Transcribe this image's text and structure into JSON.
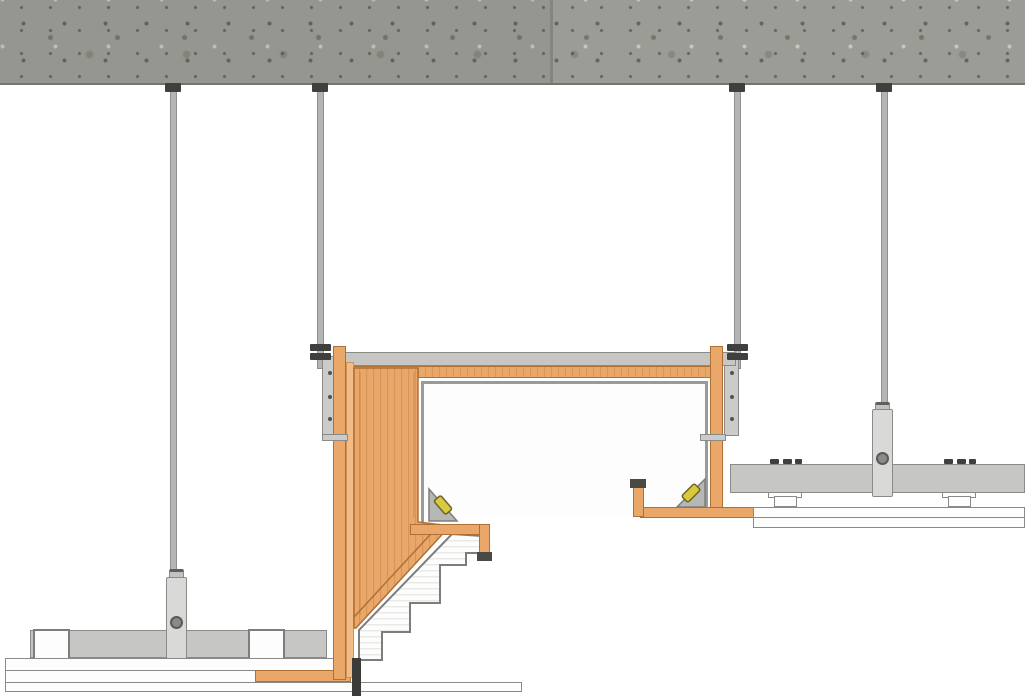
{
  "diagram": {
    "title": "suspended-ceiling-bulkhead-section-detail",
    "type": "construction-section",
    "visible_text": []
  },
  "colors": {
    "page_bg": "#ffffff",
    "concrete": "#9c9c96",
    "concrete_edge": "#75756f",
    "wood": "#e9a86a",
    "wood_dark": "#b06f35",
    "wood_light": "#f2bc84",
    "metal": "#c6c6c4",
    "metal_stroke": "#8a8a88",
    "rod": "#b4b4b2",
    "rod_stroke": "#90908e",
    "dark": "#3f3f3d",
    "dark_cap": "#4a4a45",
    "outline": "#7d7d7b",
    "white_fill": "#fdfdfd",
    "gusset": "#b7b7b5",
    "screw_yellow": "#d9c93f",
    "screw_stroke": "#6b6428",
    "stripe": "#e9e9e6",
    "bracket": "#cbcbc9",
    "adjuster": "#d9d9d7",
    "bolt": "#8a8a88",
    "black_trim": "#3b3b39"
  }
}
